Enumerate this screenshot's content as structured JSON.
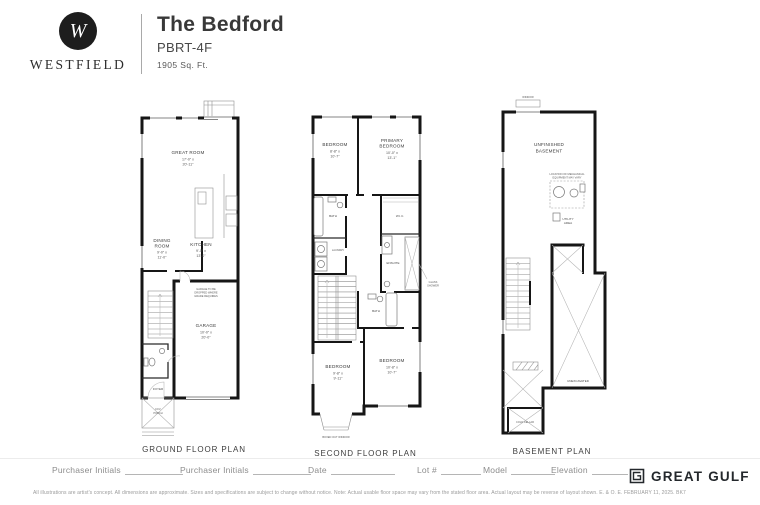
{
  "header": {
    "brand": "WESTFIELD",
    "monogram": "W",
    "title": "The Bedford",
    "model_code": "PBRT-4F",
    "area": "1905 Sq. Ft."
  },
  "plans": {
    "ground": {
      "label": "GROUND FLOOR PLAN",
      "great_room": {
        "name": "GREAT ROOM",
        "dim1": "17'-0\" x",
        "dim2": "20'-11\""
      },
      "dining": {
        "name1": "DINING",
        "name2": "ROOM",
        "dim1": "9'-0\" x",
        "dim2": "11'-0\""
      },
      "kitchen": {
        "name": "KITCHEN",
        "dim1": "9'-0\" x",
        "dim2": "13'-0\""
      },
      "garage": {
        "name": "GARAGE",
        "dim1": "10'-0\" x",
        "dim2": "20'-0\"",
        "note1": "GARAGE TO BE",
        "note2": "DROPPED WHERE",
        "note3": "GRADE REQUIRES"
      },
      "foyer": "FOYER",
      "porch1": "COV.",
      "porch2": "PORCH"
    },
    "second": {
      "label": "SECOND FLOOR PLAN",
      "bedroom2": {
        "name": "BEDROOM",
        "dim1": "8'-8\" x",
        "dim2": "10'-7\""
      },
      "primary": {
        "name1": "PRIMARY",
        "name2": "BEDROOM",
        "dim1": "10'-0\" x",
        "dim2": "13'-1\""
      },
      "bath2": "BATH",
      "laundry": "LAUNDRY",
      "wic": "W.I.C.",
      "ensuite": "ENSUITE",
      "main_bath": "BATH",
      "bedroom3": {
        "name": "BEDROOM",
        "dim1": "9'-8\" x",
        "dim2": "9'-11\""
      },
      "bedroom4": {
        "name": "BEDROOM",
        "dim1": "10'-8\" x",
        "dim2": "10'-7\""
      },
      "shower_note1": "GLASS",
      "shower_note2": "SHOWER",
      "bay_note": "BOXED OUT WINDOW"
    },
    "basement": {
      "label": "BASEMENT PLAN",
      "window_note": "WINDOW",
      "room1": "UNFINISHED",
      "room2": "BASEMENT",
      "mech_note1": "LOCATION OF MECHANICAL",
      "mech_note2": "EQUIPMENT MAY VARY",
      "utility1": "UTILITY",
      "utility2": "AREA",
      "unexcavated": "UNEXCAVATED",
      "cold_cellar": "COLD CELLAR"
    }
  },
  "footer": {
    "fields": [
      "Purchaser Initials",
      "Purchaser Initials",
      "Date",
      "Lot #",
      "Model",
      "Elevation"
    ],
    "brand": "GREAT GULF",
    "disclaimer": "All illustrations are artist's concept. All dimensions are approximate. Sizes and specifications are subject to change without notice. Note: Actual usable floor space may vary from the stated floor area. Actual layout may be reverse of layout shown. E. & O. E. FEBRUARY 11, 2025.  BK7"
  }
}
